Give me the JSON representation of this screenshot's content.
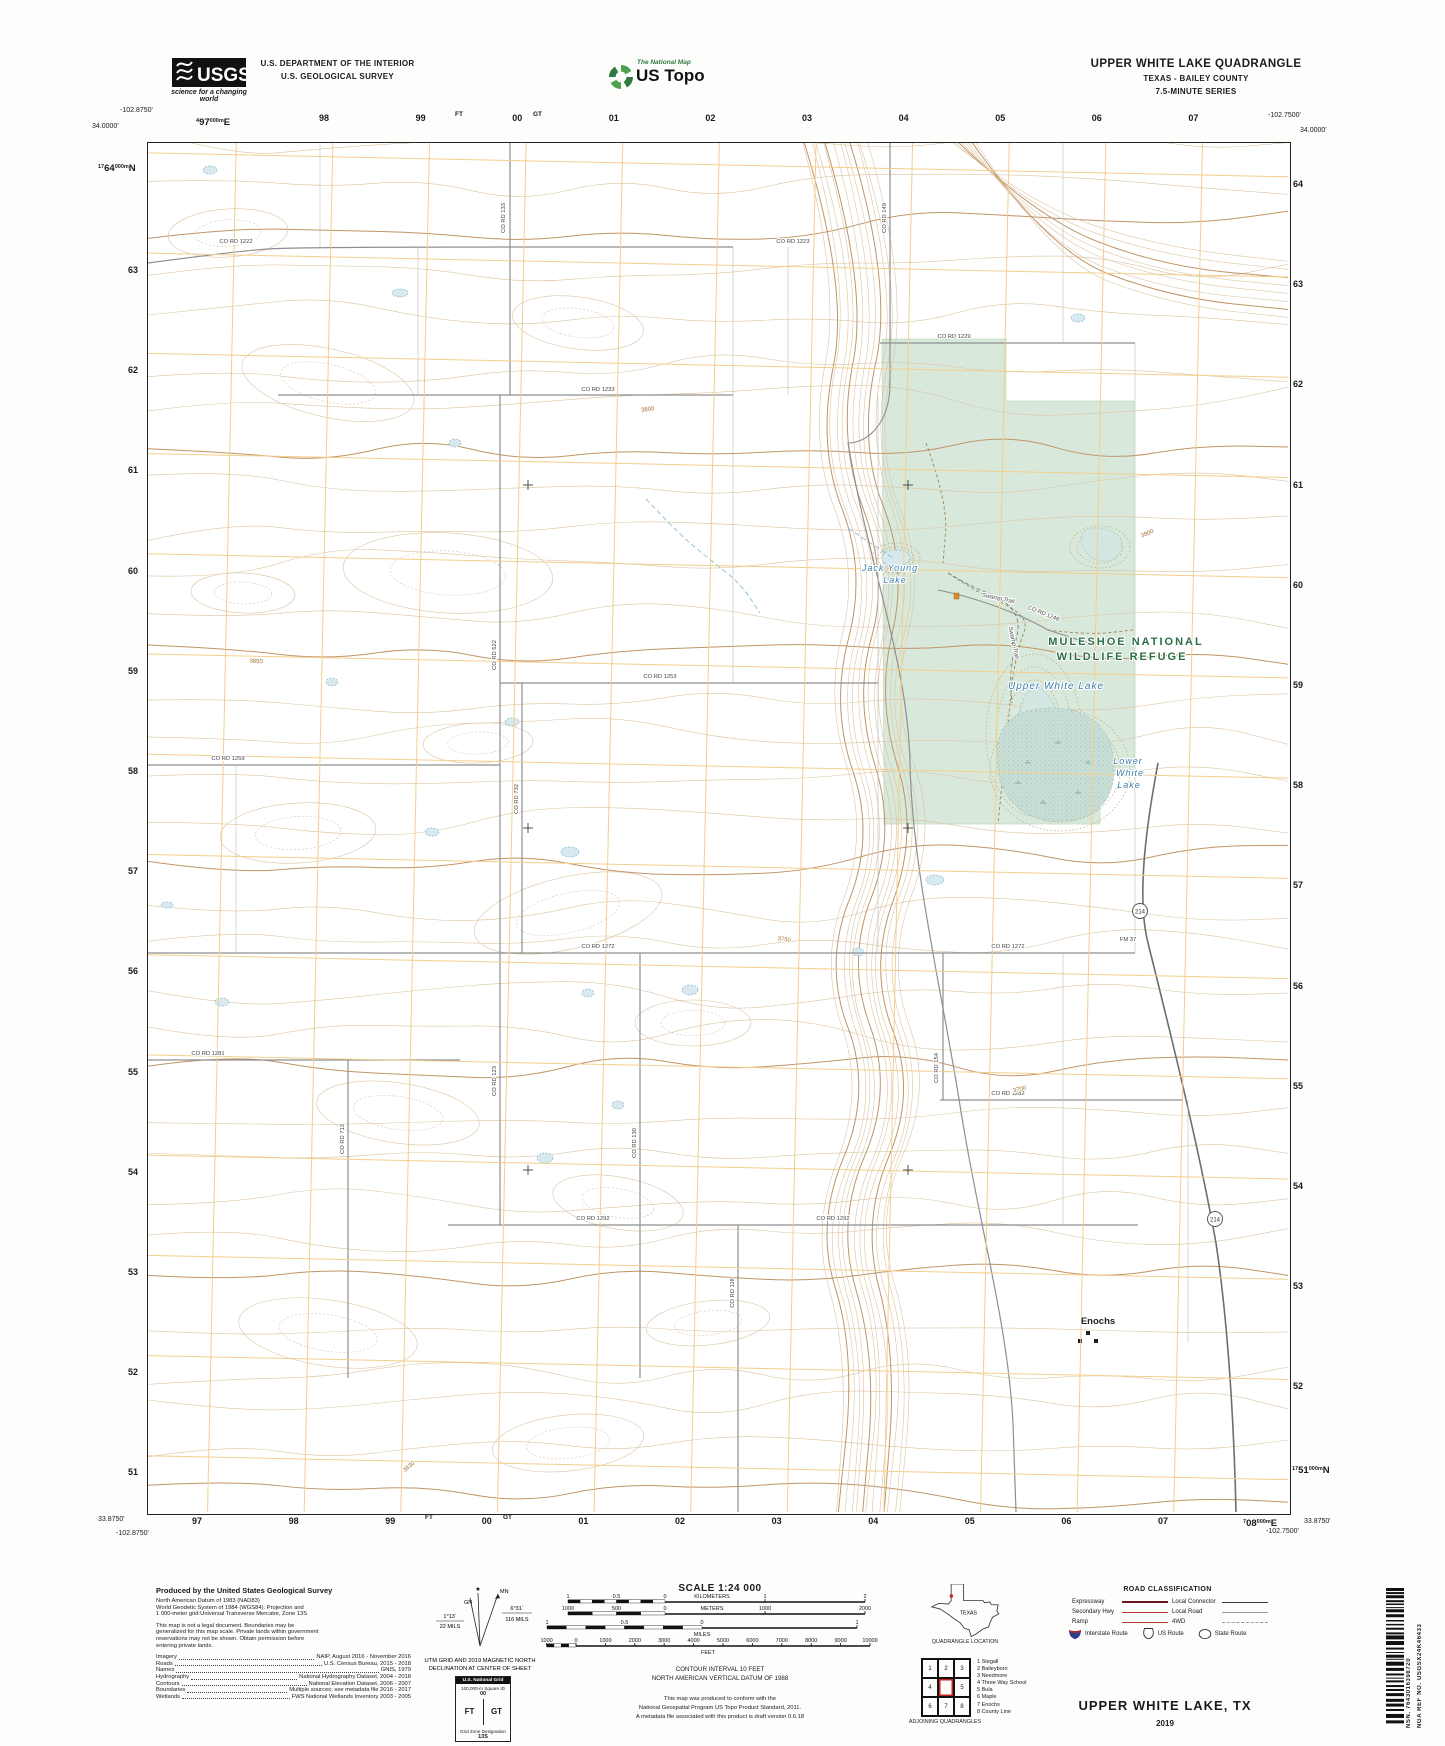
{
  "header": {
    "usgs": {
      "name": "USGS",
      "tagline": "science for a changing world"
    },
    "dept1": "U.S. DEPARTMENT OF THE INTERIOR",
    "dept2": "U.S. GEOLOGICAL SURVEY",
    "ustopo": {
      "brand": "The National Map",
      "name": "US Topo"
    },
    "quad": {
      "title": "UPPER WHITE LAKE QUADRANGLE",
      "subtitle": "TEXAS - BAILEY COUNTY",
      "series": "7.5-MINUTE SERIES"
    }
  },
  "margin": {
    "corner_tl": {
      "lon": "-102.8750'",
      "lat": "34.0000'"
    },
    "corner_tr": {
      "lon": "-102.7500'",
      "lat": "34.0000'"
    },
    "corner_bl": {
      "lat": "33.8750'",
      "lon": "-102.8750'"
    },
    "corner_br": {
      "lon": "-102.7500'",
      "lat": "33.8750'"
    },
    "utm_top_first": {
      "pre": "4",
      "main": "97",
      "sup": "000m",
      "suf": "E"
    },
    "utm_left_first": {
      "pre": "17",
      "main": "64",
      "sup": "000m",
      "suf": "N"
    },
    "utm_right_last": {
      "pre": "17",
      "main": "51",
      "sup": "000m",
      "suf": "N"
    },
    "utm_bottom_last": {
      "pre": "7",
      "main": "08",
      "sup": "000m",
      "suf": "E"
    },
    "grid_top": [
      "98",
      "99",
      "00",
      "01",
      "02",
      "03",
      "04",
      "05",
      "06",
      "07"
    ],
    "grid_bottom": [
      "97",
      "98",
      "99",
      "00",
      "01",
      "02",
      "03",
      "04",
      "05",
      "06",
      "07"
    ],
    "grid_left": [
      "63",
      "62",
      "61",
      "60",
      "59",
      "58",
      "57",
      "56",
      "55",
      "54",
      "53",
      "52",
      "51"
    ],
    "grid_right": [
      "64",
      "63",
      "62",
      "61",
      "60",
      "59",
      "58",
      "57",
      "56",
      "55",
      "54",
      "53",
      "52"
    ],
    "square_ft": "FT",
    "square_gt": "GT"
  },
  "map_labels": {
    "refuge_line1": "MULESHOE NATIONAL",
    "refuge_line2": "WILDLIFE REFUGE",
    "water": [
      {
        "t": "Jack Young",
        "x": 742,
        "y": 428,
        "s": 9
      },
      {
        "t": "Lake",
        "x": 747,
        "y": 440,
        "s": 9
      },
      {
        "t": "Upper White Lake",
        "x": 908,
        "y": 546,
        "s": 10
      },
      {
        "t": "Lower",
        "x": 980,
        "y": 621,
        "s": 9
      },
      {
        "t": "White",
        "x": 982,
        "y": 633,
        "s": 9
      },
      {
        "t": "Lake",
        "x": 981,
        "y": 645,
        "s": 9
      }
    ],
    "trail": "Swamp Trail",
    "trail_pos": [
      {
        "x": 850,
        "y": 457,
        "r": 12
      },
      {
        "x": 864,
        "y": 500,
        "r": 78
      }
    ],
    "town": "Enochs",
    "route": "214",
    "route_pos": [
      {
        "x": 992,
        "y": 770
      },
      {
        "x": 1067,
        "y": 1078
      }
    ],
    "roads": [
      {
        "t": "CO RD 1222",
        "x": 88,
        "y": 100,
        "r": 0
      },
      {
        "t": "CO RD 1223",
        "x": 645,
        "y": 100,
        "r": 0
      },
      {
        "t": "CO RD 1229",
        "x": 806,
        "y": 195,
        "r": 0
      },
      {
        "t": "CO RD 1233",
        "x": 450,
        "y": 248,
        "r": 0
      },
      {
        "t": "CO RD 1253",
        "x": 512,
        "y": 535,
        "r": 0
      },
      {
        "t": "CO RD 1259",
        "x": 80,
        "y": 617,
        "r": 0
      },
      {
        "t": "CO RD 1272",
        "x": 450,
        "y": 805,
        "r": 0
      },
      {
        "t": "CO RD 1272",
        "x": 860,
        "y": 805,
        "r": 0
      },
      {
        "t": "CO RD 1281",
        "x": 60,
        "y": 912,
        "r": 0
      },
      {
        "t": "CO RD 1282",
        "x": 860,
        "y": 952,
        "r": 0
      },
      {
        "t": "CO RD 1292",
        "x": 445,
        "y": 1077,
        "r": 0
      },
      {
        "t": "CO RD 1292",
        "x": 685,
        "y": 1077,
        "r": 0
      },
      {
        "t": "CO RD 133",
        "x": 357,
        "y": 75,
        "r": -90
      },
      {
        "t": "CO RD 149",
        "x": 738,
        "y": 75,
        "r": -90
      },
      {
        "t": "CO RD 522",
        "x": 348,
        "y": 512,
        "r": -90
      },
      {
        "t": "CO RD 732",
        "x": 370,
        "y": 656,
        "r": -90
      },
      {
        "t": "CO RD 123",
        "x": 348,
        "y": 938,
        "r": -90
      },
      {
        "t": "CO RD 130",
        "x": 488,
        "y": 1000,
        "r": -90
      },
      {
        "t": "CO RD 713",
        "x": 196,
        "y": 996,
        "r": -90
      },
      {
        "t": "CO RD 154",
        "x": 790,
        "y": 925,
        "r": -90
      },
      {
        "t": "CO RD 118",
        "x": 586,
        "y": 1150,
        "r": -90
      },
      {
        "t": "CO RD 1248",
        "x": 895,
        "y": 472,
        "r": 22
      },
      {
        "t": "FM 37",
        "x": 980,
        "y": 798,
        "r": 0
      }
    ],
    "elev": [
      {
        "t": "3800",
        "x": 500,
        "y": 268,
        "r": -8
      },
      {
        "t": "3850",
        "x": 108,
        "y": 520,
        "r": 3
      },
      {
        "t": "3800",
        "x": 1000,
        "y": 392,
        "r": -24
      },
      {
        "t": "3750",
        "x": 636,
        "y": 798,
        "r": 8
      },
      {
        "t": "3700",
        "x": 872,
        "y": 948,
        "r": -14
      },
      {
        "t": "3830",
        "x": 262,
        "y": 1325,
        "r": -40
      }
    ]
  },
  "footer": {
    "produced": {
      "title": "Produced by the United States Geological Survey",
      "datum": [
        "North American Datum of 1983 (NAD83)",
        "World Geodetic System of 1984 (WGS84).  Projection and",
        "1 000-meter grid:Universal Transverse Mercator, Zone 13S"
      ],
      "legal": [
        "This map is not a legal document. Boundaries may be",
        "generalized for this map scale. Private lands within government",
        "reservations may not be shown. Obtain permission before",
        "entering private lands."
      ],
      "sources": [
        {
          "k": "Imagery",
          "v": "NAIP, August 2016 - November 2016"
        },
        {
          "k": "Roads",
          "v": "U.S. Census Bureau, 2015 - 2018"
        },
        {
          "k": "Names",
          "v": "GNIS, 1979"
        },
        {
          "k": "Hydrography",
          "v": "National Hydrography Dataset, 2004 - 2018"
        },
        {
          "k": "Contours",
          "v": "National Elevation Dataset, 2006 - 2007"
        },
        {
          "k": "Boundaries",
          "v": "Multiple sources; see metadata file 2016 - 2017"
        },
        {
          "k": "Wetlands",
          "v": "FWS National Wetlands Inventory 2003 - 2005"
        }
      ]
    },
    "declination": {
      "mn": "MN",
      "gn": "GN",
      "left_deg": "1°13´",
      "left_mils": "22 MILS",
      "right_deg": "6°31´",
      "right_mils": "116 MILS",
      "caption1": "UTM GRID AND 2019 MAGNETIC NORTH",
      "caption2": "DECLINATION AT CENTER OF SHEET"
    },
    "usng": {
      "title": "U.S. National Grid",
      "sq": "100,000-m Square ID",
      "zero": "00",
      "ft": "FT",
      "gt": "GT",
      "gzd_label": "Grid Zone Designation",
      "gzd": "13S"
    },
    "scale": {
      "title": "SCALE 1:24 000",
      "km": {
        "unit": "KILOMETERS",
        "left": [
          "1",
          "0.5",
          "0"
        ],
        "right": [
          "1",
          "2"
        ]
      },
      "m": {
        "unit": "METERS",
        "left": [
          "1000",
          "500",
          "0"
        ],
        "right": [
          "1000",
          "2000"
        ]
      },
      "mi": {
        "unit": "MILES",
        "left": [
          "1",
          "0.5",
          "0"
        ],
        "right": [
          "1"
        ]
      },
      "ft": {
        "unit": "FEET",
        "ticks": [
          "1000",
          "0",
          "1000",
          "2000",
          "3000",
          "4000",
          "5000",
          "6000",
          "7000",
          "8000",
          "9000",
          "10000"
        ]
      }
    },
    "contour_note1": "CONTOUR INTERVAL 10 FEET",
    "contour_note2": "NORTH AMERICAN VERTICAL DATUM OF 1988",
    "standard": [
      "This map was produced to conform with the",
      "National Geospatial Program US Topo Product Standard, 2011.",
      "A metadata file associated with this product is draft version 0.6.18"
    ],
    "location": {
      "state": "TEXAS",
      "caption": "QUADRANGLE LOCATION"
    },
    "adjoining": {
      "caption": "ADJOINING QUADRANGLES",
      "cells": [
        "1",
        "2",
        "3",
        "4",
        "5",
        "6",
        "7",
        "8"
      ],
      "names": [
        "1 Stegall",
        "2 Baileyboro",
        "3 Needmore",
        "4 Three Way School",
        "5 Bula",
        "6 Maple",
        "7 Enochs",
        "8 County Line"
      ]
    },
    "roadclass": {
      "title": "ROAD CLASSIFICATION",
      "rows_left": [
        "Expressway",
        "Secondary Hwy",
        "Ramp"
      ],
      "rows_right": [
        "Local Connector",
        "Local Road",
        "4WD"
      ],
      "shields": [
        "Interstate Route",
        "US Route",
        "State Route"
      ]
    },
    "sheet_title": "UPPER WHITE LAKE,  TX",
    "sheet_year": "2019"
  },
  "barcode": {
    "nsn": "NSN.  7643016398720",
    "nga": "NGA REF NO.  USGSX24K46433"
  }
}
